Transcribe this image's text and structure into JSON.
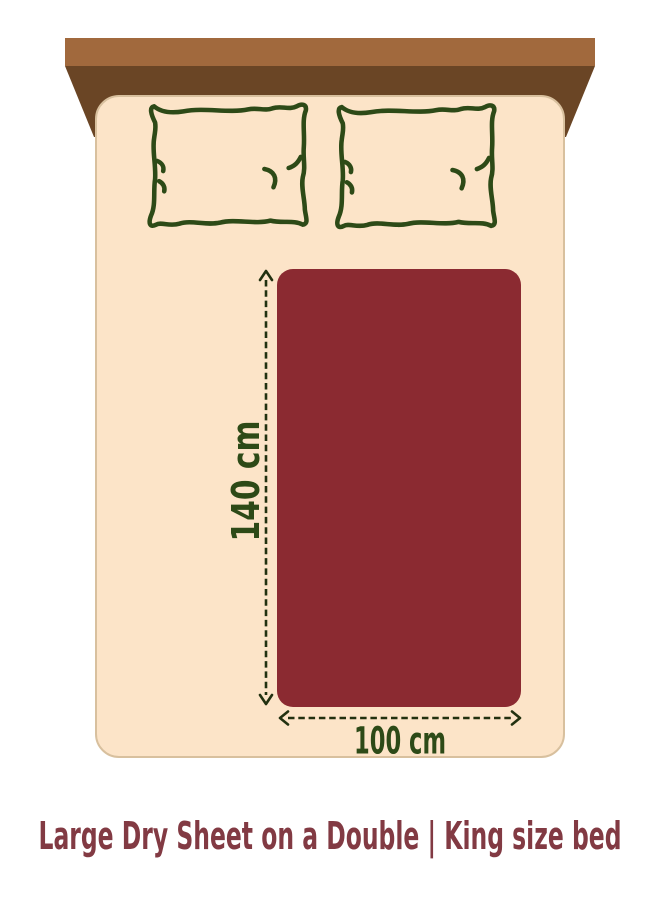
{
  "illustration": {
    "caption": "Large Dry Sheet on a Double | King size bed",
    "sheet": {
      "height_label": "140 cm",
      "width_label": "100 cm",
      "height_cm": 140,
      "width_cm": 100
    },
    "icons": {
      "pillow_left": "pillow-outline-icon",
      "pillow_right": "pillow-outline-icon"
    },
    "colors": {
      "background": "#ffffff",
      "headboard_top": "#a1693d",
      "headboard_front": "#6a4525",
      "mattress": "#fce4c8",
      "mattress_edge": "#d8c09e",
      "sheet": "#8b2a31",
      "outline_green": "#2d4a17",
      "dimension_line": "#223110",
      "caption_text": "#823a43"
    }
  }
}
